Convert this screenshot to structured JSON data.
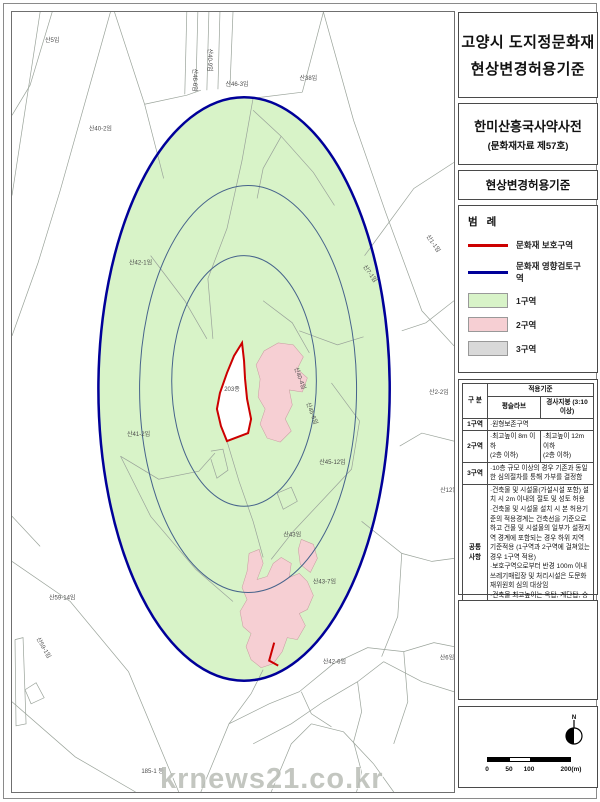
{
  "page": {
    "watermark": "krnews21.co.kr"
  },
  "header": {
    "title_line1": "고양시 도지정문화재",
    "title_line2": "현상변경허용기준",
    "site_name": "한미산흥국사약사전",
    "site_designation": "(문화재자료 제57호)",
    "subtitle": "현상변경허용기준"
  },
  "legend": {
    "title": "범 례",
    "items": [
      {
        "type": "line",
        "color": "#cc0000",
        "label": "문화재 보호구역"
      },
      {
        "type": "line",
        "color": "#000099",
        "label": "문화재 영향검토구역"
      },
      {
        "type": "swatch",
        "color": "#d8f3c8",
        "label": "1구역"
      },
      {
        "type": "swatch",
        "color": "#f6cfd3",
        "label": "2구역"
      },
      {
        "type": "swatch",
        "color": "#d9d9d9",
        "label": "3구역"
      }
    ]
  },
  "criteria_table": {
    "row_header": "구 분",
    "col_group": "적용기준",
    "col1": "평슬라브",
    "col2": "경사지붕 (3:10 이상)",
    "zone1_label": "1구역",
    "zone1_text": "·원형보존구역",
    "zone2_label": "2구역",
    "zone2_flat": "·최고높이 8m 이하\n(2층 이하)",
    "zone2_slope": "·최고높이 12m 이하\n(2층 이하)",
    "zone3_label": "3구역",
    "zone3_text": "·10층 규모 이상의 경우 기존과 동일한 심의절차를 통해 가부를 결정함",
    "common_label": "공통\n사항",
    "common_text": "·건축물 및 시설물(가설시설 포함) 설치 시 2m 이내의 절토 및 성토 허용\n·건축물 및 시설물 설치 시 본 허용기준의 적용경계는 건축선을 기준으로 하고 건물 및 시설물의 일부가 설정지역 경계에 포함되는 경우 하위 지역 기준적용 (1구역과 2구역에 걸쳐있는 경우 1구역 적용)\n·보호구역으로부터 반경 100m 이내 쓰레기매립장 및 처리시설은 도문화재위원회 심의 대상임\n·건축물 최고높이는 옥탑, 계단탑, 승강기탑, 망루, 장식탑 등 기타 이와 유사한 것을 포함한 높이임"
  },
  "scale_bar": {
    "ticks": [
      "0",
      "50",
      "100",
      "200(m)"
    ],
    "north_label": "N"
  },
  "map": {
    "colors": {
      "zone1_fill": "#d8f3c8",
      "zone2_fill": "#f6cfd3",
      "ring_outer": "#000099",
      "ring_inner": "#46638b",
      "protection": "#cc0000",
      "parcel_line": "#9aa39a"
    },
    "protected_parcel_label": "203종",
    "parcel_labels": [
      {
        "text": "산5임",
        "x": 52,
        "y": 42
      },
      {
        "text": "산40-2임",
        "x": 100,
        "y": 130
      },
      {
        "text": "산38임",
        "x": 307,
        "y": 80
      },
      {
        "text": "산46-3임",
        "x": 236,
        "y": 86
      },
      {
        "text": "산46-6임",
        "x": 192,
        "y": 80,
        "rot": 90
      },
      {
        "text": "산40-9임",
        "x": 207,
        "y": 60,
        "rot": 90
      },
      {
        "text": "산1-1임",
        "x": 430,
        "y": 244,
        "rot": 55
      },
      {
        "text": "산7-1임",
        "x": 367,
        "y": 274,
        "rot": 55
      },
      {
        "text": "산2-2임",
        "x": 437,
        "y": 393
      },
      {
        "text": "산42-1임",
        "x": 140,
        "y": 264
      },
      {
        "text": "산41-2임",
        "x": 138,
        "y": 435
      },
      {
        "text": "203종",
        "x": 231,
        "y": 390
      },
      {
        "text": "산40-4임",
        "x": 297,
        "y": 378,
        "rot": 70
      },
      {
        "text": "산45-6임",
        "x": 309,
        "y": 413,
        "rot": 70
      },
      {
        "text": "산45-12임",
        "x": 331,
        "y": 463
      },
      {
        "text": "산43임",
        "x": 291,
        "y": 535
      },
      {
        "text": "산43-7임",
        "x": 323,
        "y": 582
      },
      {
        "text": "산42-6임",
        "x": 333,
        "y": 662
      },
      {
        "text": "산12임",
        "x": 447,
        "y": 491
      },
      {
        "text": "산6임",
        "x": 445,
        "y": 658
      },
      {
        "text": "산59-14임",
        "x": 62,
        "y": 598
      },
      {
        "text": "산59-1임",
        "x": 42,
        "y": 647,
        "rot": 60
      },
      {
        "text": "185-1 등",
        "x": 152,
        "y": 771
      }
    ]
  }
}
